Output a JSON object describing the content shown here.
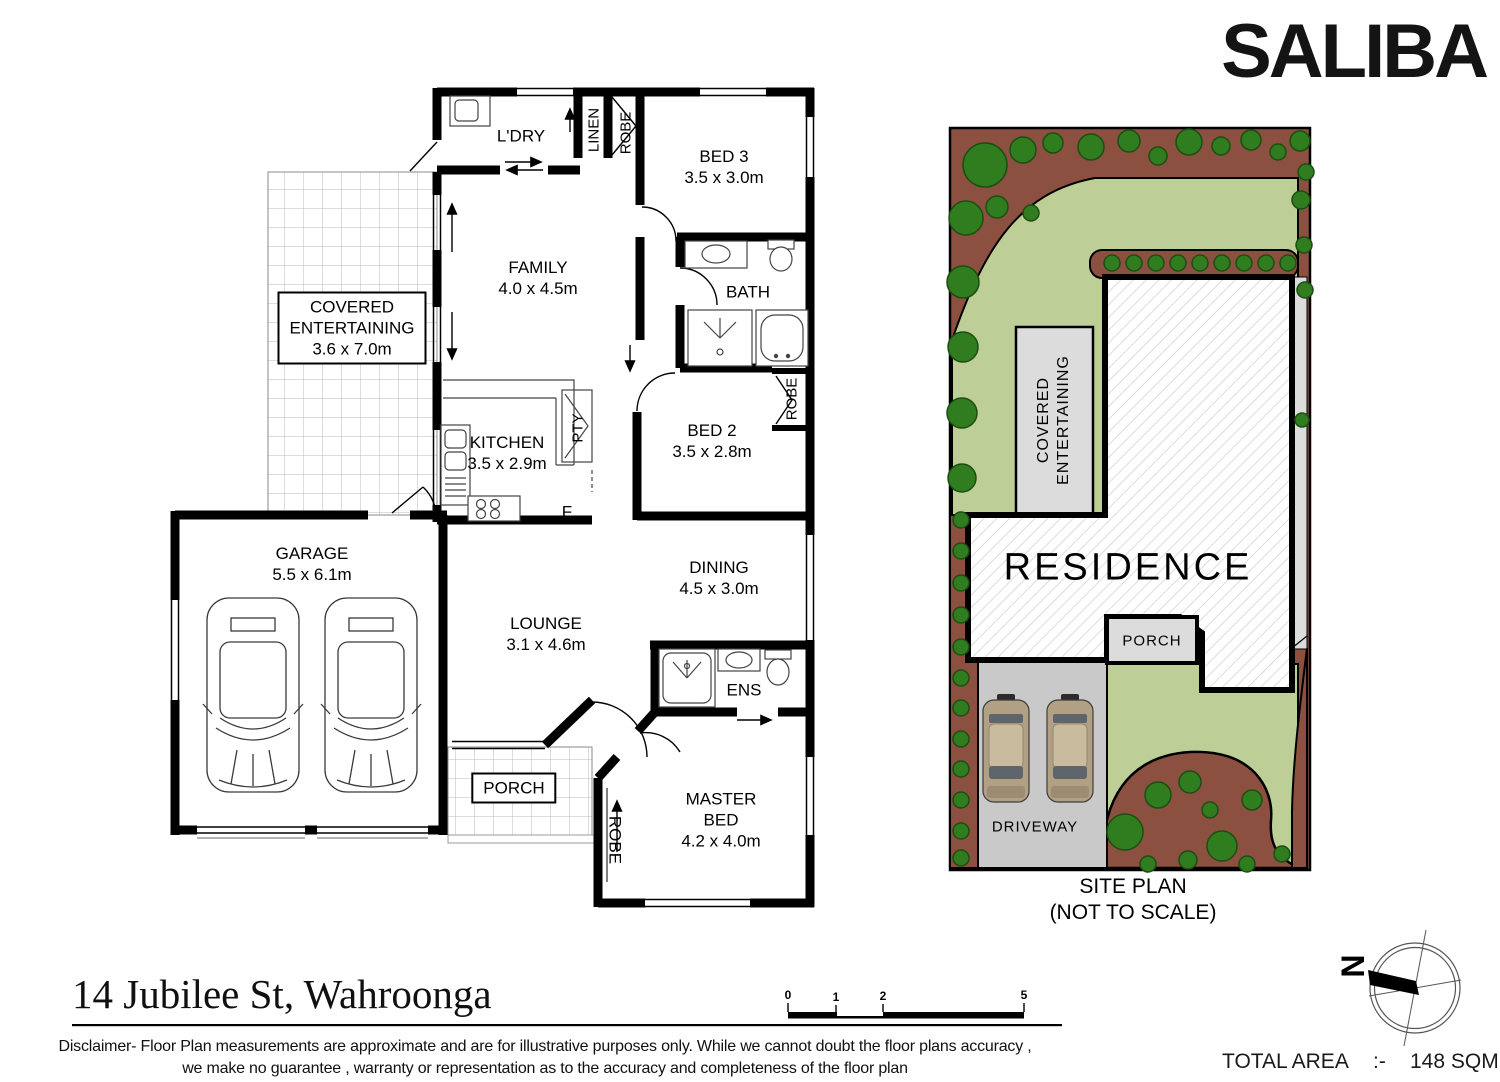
{
  "brand": {
    "logo_text": "SALIBA"
  },
  "floorplan": {
    "ldry": "L'DRY",
    "linen": "LINEN",
    "robe_top": "ROBE",
    "bed3": "BED 3",
    "bed3_dims": "3.5 x 3.0m",
    "family": "FAMILY",
    "family_dims": "4.0 x 4.5m",
    "bath": "BATH",
    "covered_line1": "COVERED",
    "covered_line2": "ENTERTAINING",
    "covered_dims": "3.6 x 7.0m",
    "kitchen": "KITCHEN",
    "kitchen_dims": "3.5 x 2.9m",
    "pty": "PTY",
    "fridge": "F",
    "bed2": "BED 2",
    "bed2_dims": "3.5 x 2.8m",
    "robe_bed2": "ROBE",
    "garage": "GARAGE",
    "garage_dims": "5.5 x 6.1m",
    "dining": "DINING",
    "dining_dims": "4.5 x 3.0m",
    "lounge": "LOUNGE",
    "lounge_dims": "3.1 x 4.6m",
    "ens": "ENS",
    "porch": "PORCH",
    "robe_master": "ROBE",
    "master_line1": "MASTER",
    "master_line2": "BED",
    "master_dims": "4.2 x 4.0m"
  },
  "siteplan": {
    "residence": "RESIDENCE",
    "covered_line1": "COVERED",
    "covered_line2": "ENTERTAINING",
    "porch": "PORCH",
    "driveway": "DRIVEWAY",
    "title_line1": "SITE PLAN",
    "title_line2": "(NOT TO SCALE)"
  },
  "compass": {
    "north": "N"
  },
  "scalebar": {
    "ticks": [
      "0",
      "1",
      "2",
      "5"
    ]
  },
  "footer": {
    "address": "14 Jubilee St, Wahroonga",
    "disclaimer_line1": "Disclaimer- Floor Plan measurements are approximate and are for illustrative purposes only. While we cannot doubt the floor plans accuracy ,",
    "disclaimer_line2": "we make no guarantee , warranty or representation as to the accuracy and completeness of the floor plan",
    "total_area_label": "TOTAL AREA",
    "total_area_sep": ":-",
    "total_area_value": "148 SQM"
  },
  "colors": {
    "wall": "#000000",
    "lawn": "#bdcf97",
    "garden": "#8c5040",
    "tree": "#2f7d1f",
    "tree_edge": "#1c4d12",
    "driveway": "#c9c9c9",
    "paving_light": "#dcdcdc",
    "car_body": "#b1a083",
    "car_roof": "#c9bb9e",
    "car_glass": "#5f666b"
  }
}
